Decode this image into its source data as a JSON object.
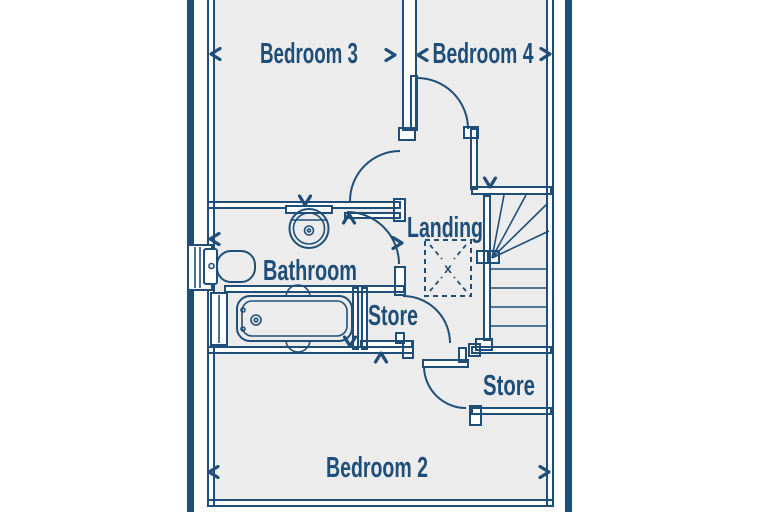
{
  "floorplan": {
    "labels": {
      "bedroom3": "Bedroom 3",
      "bedroom4": "Bedroom 4",
      "landing": "Landing",
      "bathroom": "Bathroom",
      "store_middle": "Store",
      "store_lower": "Store",
      "bedroom2": "Bedroom 2",
      "loft_hatch_mark": "x"
    },
    "colors": {
      "line": "#1f4e79",
      "room_fill": "#ececec",
      "wall_fill": "#ffffff",
      "background": "#ffffff"
    },
    "fixtures": [
      "bath-icon",
      "wash-basin-icon",
      "toilet-icon",
      "staircase-icon",
      "loft-hatch-icon",
      "window-icon",
      "door-arc-icon",
      "dimension-arrow-icon"
    ]
  }
}
